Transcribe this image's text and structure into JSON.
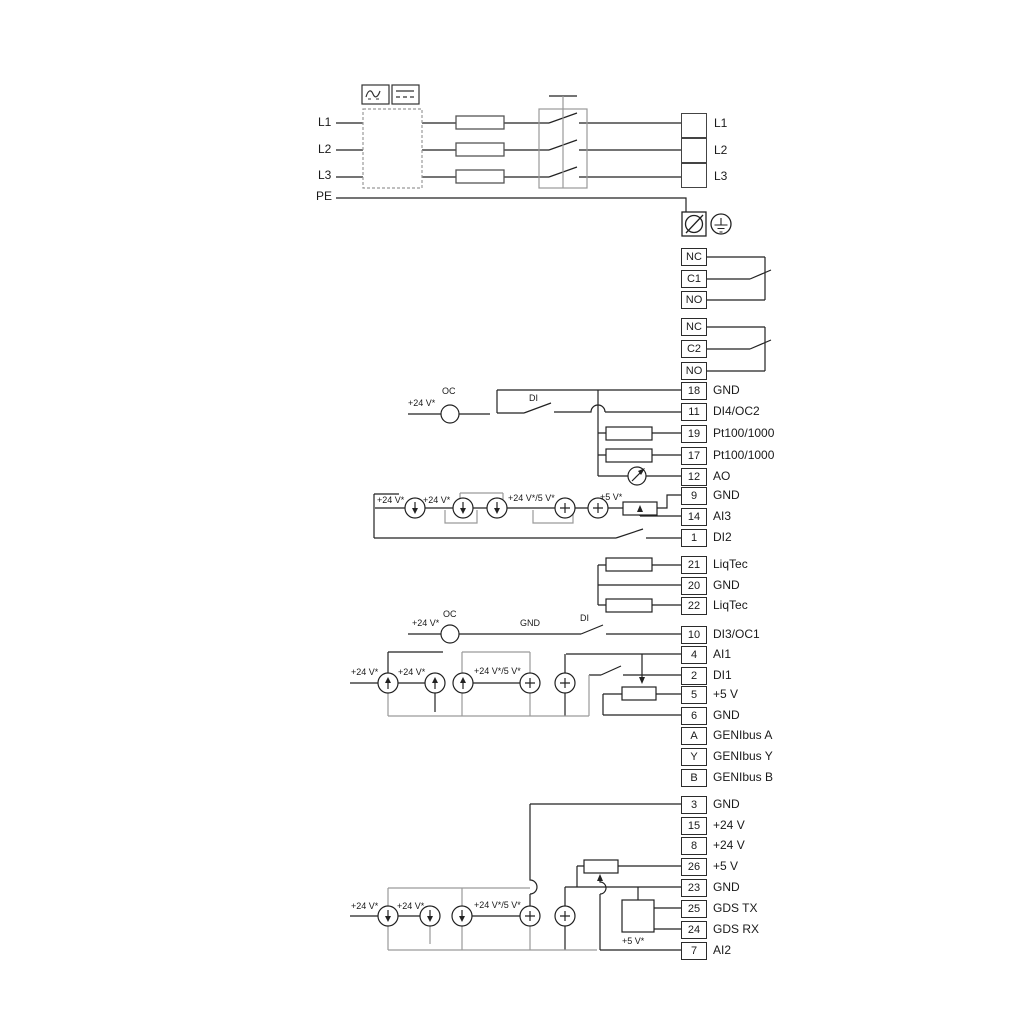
{
  "diagram": {
    "power": {
      "inputs": [
        "L1",
        "L2",
        "L3",
        "PE"
      ],
      "outputs": [
        "L1",
        "L2",
        "L3"
      ]
    },
    "relay1": {
      "terminals": [
        "NC",
        "C1",
        "NO"
      ]
    },
    "relay2": {
      "terminals": [
        "NC",
        "C2",
        "NO"
      ]
    },
    "io1": {
      "terminals": [
        {
          "no": "18",
          "label": "GND"
        },
        {
          "no": "11",
          "label": "DI4/OC2"
        },
        {
          "no": "19",
          "label": "Pt100/1000"
        },
        {
          "no": "17",
          "label": "Pt100/1000"
        },
        {
          "no": "12",
          "label": "AO"
        },
        {
          "no": "9",
          "label": "GND"
        },
        {
          "no": "14",
          "label": "AI3"
        },
        {
          "no": "1",
          "label": "DI2"
        }
      ]
    },
    "liqtec": {
      "terminals": [
        {
          "no": "21",
          "label": "LiqTec"
        },
        {
          "no": "20",
          "label": "GND"
        },
        {
          "no": "22",
          "label": "LiqTec"
        }
      ]
    },
    "io2": {
      "terminals": [
        {
          "no": "10",
          "label": "DI3/OC1"
        },
        {
          "no": "4",
          "label": "AI1"
        },
        {
          "no": "2",
          "label": "DI1"
        },
        {
          "no": "5",
          "label": "+5 V"
        },
        {
          "no": "6",
          "label": "GND"
        },
        {
          "no": "A",
          "label": "GENIbus A"
        },
        {
          "no": "Y",
          "label": "GENIbus Y"
        },
        {
          "no": "B",
          "label": "GENIbus B"
        }
      ]
    },
    "io3": {
      "terminals": [
        {
          "no": "3",
          "label": "GND"
        },
        {
          "no": "15",
          "label": "+24 V"
        },
        {
          "no": "8",
          "label": "+24 V"
        },
        {
          "no": "26",
          "label": "+5 V"
        },
        {
          "no": "23",
          "label": "GND"
        },
        {
          "no": "25",
          "label": "GDS TX"
        },
        {
          "no": "24",
          "label": "GDS RX"
        },
        {
          "no": "7",
          "label": "AI2"
        }
      ]
    },
    "ann": {
      "v24": "+24 V*",
      "v24v5": "+24 V*/5 V*",
      "v5": "+5 V*",
      "oc": "OC",
      "di": "DI",
      "gnd": "GND"
    },
    "colors": {
      "line": "#222222",
      "alt": "#9a9a9a"
    }
  }
}
